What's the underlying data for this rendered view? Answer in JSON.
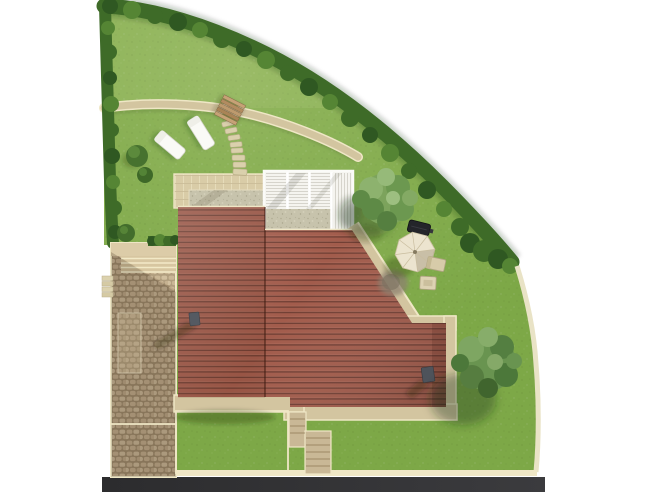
{
  "scene": {
    "type": "garden-site-plan-rendering",
    "description": "Aerial 3D site plan rendering of a house with terracotta tiled roof, white pergola, curved hedged garden lawn, cobbled driveway, garden furniture and street"
  },
  "palette": {
    "bg": "#FFFFFF",
    "lawn": "#7DA847",
    "lawnShadow": "#5E8A3A",
    "hedge": "#3E6B28",
    "hedgeLight": "#558534",
    "hedgeDark": "#2F5822",
    "roof": "#A25C4C",
    "roofLine": "#713F34",
    "pathSand": "#D3C5A0",
    "pathEdge": "#EFE7C6",
    "patio": "#D9CCA7",
    "gravel": "#C7C3AC",
    "cobble": "#BCA787",
    "cobbleJoint": "#9A8668",
    "pergola": "#F5F4EF",
    "pergolaLine": "#D2D1C8",
    "wood": "#BE9A6E",
    "furnitureWhite": "#FAFAF6",
    "parasol": "#ECE4CF",
    "grill": "#24252A",
    "chimney": "#555A62",
    "wall": "#E9E3C6",
    "road": "#323234",
    "treeMid": "#699450",
    "treeLight": "#87AD6A",
    "treeDark": "#4C783A"
  },
  "objects": {
    "lawn": "garden lawn",
    "hedge": "boundary hedge",
    "garden_path": "gravel garden path",
    "stepping_stones": "stepping stone path",
    "timber_steps": "timber garden steps",
    "sun_loungers": "sun loungers",
    "driveway": "cobbled driveway courtyard",
    "entrance_steps": "driveway entrance steps",
    "patio": "tiled patio",
    "gravel_bed": "gravel bed",
    "pergola": "white slatted pergola",
    "house_roof": "terracotta tiled house roof",
    "chimney": "roof chimney",
    "perimeter_path": "paved perimeter path",
    "rear_steps": "rear stair path",
    "trees": "garden trees",
    "parasol": "patio parasol",
    "barbecue": "barbecue grill",
    "chairs": "garden chairs",
    "wall": "boundary wall",
    "street": "street"
  }
}
